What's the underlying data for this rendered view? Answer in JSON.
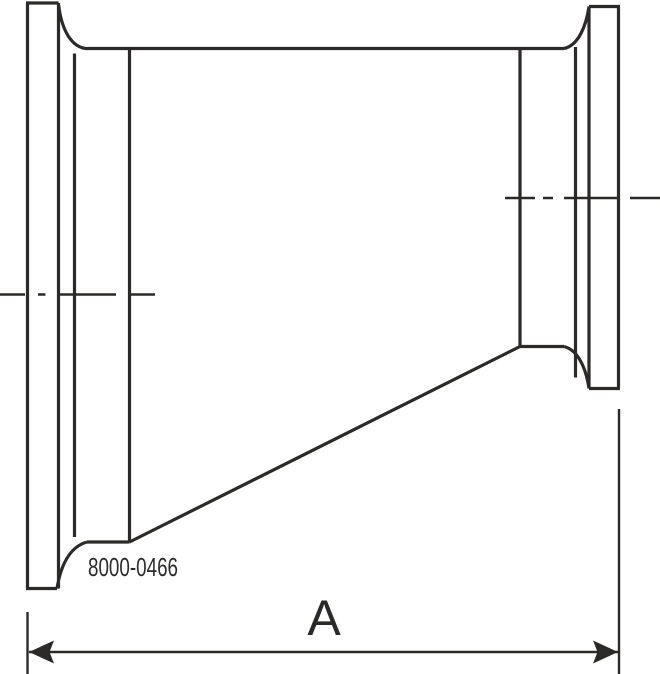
{
  "drawing": {
    "title": "Eccentric reducer with clamp ends — dimensional line drawing",
    "part_number": "8000-0466",
    "dimension_label": "A"
  },
  "colors": {
    "line": "#2b2a29",
    "background": "#ffffff"
  }
}
